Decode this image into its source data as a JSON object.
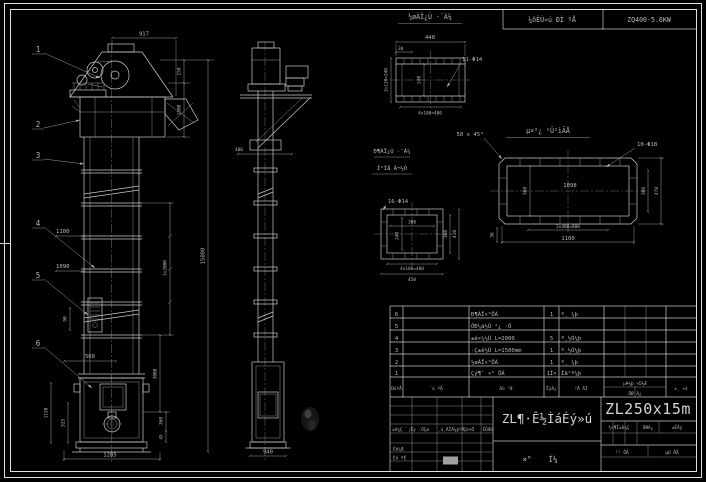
{
  "header_strip": {
    "label": "¼õËÙ»ú ÐÍ ºÅ",
    "model": "ZQ400-5.6KW"
  },
  "front_view": {
    "balloons": [
      "1",
      "2",
      "3",
      "4",
      "5",
      "6"
    ],
    "dims": {
      "d917": "917",
      "d150": "150",
      "d1500": "1500",
      "d15000": "15000",
      "d3x2000": "3x2000",
      "d3000": "3000",
      "d360": "360",
      "d45": "45",
      "d1100": "1100",
      "d1090": "1090",
      "d90": "90",
      "d560": "560",
      "d1150": "1150",
      "d325": "325",
      "d1285": "1285"
    }
  },
  "side_view": {
    "dims": {
      "d400": "400",
      "d940": "940"
    }
  },
  "inlet_flange": {
    "label": "½øÁÏ¿Ú ·¨À¼",
    "dims": {
      "width": "440",
      "offset": "30",
      "holes": "11-Φ14",
      "left": "2x120=240",
      "inner": "240",
      "bottom": "4x100=400"
    }
  },
  "base_flange": {
    "label": "µ×²¿ ¹Û²ìÃÅ",
    "chamfer": "50 x 45°",
    "holes": "10-Φ18",
    "dims": {
      "inner_width": "1098",
      "inner_height": "360",
      "right_inner": "390",
      "right_outer": "470",
      "bottom_pitch": "2x400=800",
      "bottom_width": "1100",
      "corner": "36"
    }
  },
  "casing_flange": {
    "label_1": "Ð¶ÁÏ¿Ú ·¨À¼",
    "label_2": "Í²Ìå Á¬½Ó",
    "holes": "16-Φ14",
    "dims": {
      "inner_w": "300",
      "inner_h": "240",
      "right_inner": "360",
      "right_outer": "410",
      "bottom_pitch": "4x100=400",
      "bottom_width": "450"
    }
  },
  "bom": {
    "headers": {
      "no": "ÐòºÅ",
      "code": "´ú ºÅ",
      "name": "Ãû ³Æ",
      "qty": "ÊýÁ¿",
      "material": "²Ä ÁÏ",
      "weight_top": "µ¥¼þ ×Ü¼Æ",
      "weight_bottom": "ÖØ Á¿",
      "remark": "±¸ ×¢"
    },
    "rows": [
      {
        "no": "6",
        "name": "Ð¶ÁÏ×°ÖÃ",
        "qty": "1",
        "material": "º¸ ¼þ"
      },
      {
        "no": "5",
        "name": "ÖÐ¼ä½Ú ²¿ ·Ö",
        "qty": "",
        "material": ""
      },
      {
        "no": "4",
        "name": "±ê×¼½Ú L=2000",
        "qty": "5",
        "material": "º¸½Ó¼þ"
      },
      {
        "no": "3",
        "name": "·Ç±ê½Ú L=1500mm",
        "qty": "1",
        "material": "º¸½Ó¼þ"
      },
      {
        "no": "2",
        "name": "½øÁÏ×°ÖÃ",
        "qty": "1",
        "material": "º¸ ¼þ"
      },
      {
        "no": "1",
        "name": "Çý¶¯ ×° ÖÃ",
        "qty": "1Ì×",
        "material": "Íâ¹º¼þ"
      }
    ]
  },
  "title_block": {
    "model": "ZL250x15m",
    "title": "ZL¶·Ê½ÌáÉý»ú",
    "subtitle_a": "×°",
    "subtitle_b": "Í¼",
    "rev_a": "±ê¼Ç ´¦Êý ·ÖÇø",
    "rev_b": "¸ü¸ÄÎÄ¼þºÅ",
    "rev_c": "Ç©×Ö",
    "rev_d": "ÈÕÆÚ",
    "design_label": "Éè¼Æ",
    "audit_label": "Éó ºË",
    "stage_header": "½×¶Î±ê¼Ç",
    "weight_header": "ÖØÁ¿",
    "scale_header": "±ÈÀý",
    "sheet_total": "¹²  ÕÅ",
    "sheet_no": "µÚ  ÕÅ",
    "highlight_color": "#a0a0a0"
  }
}
